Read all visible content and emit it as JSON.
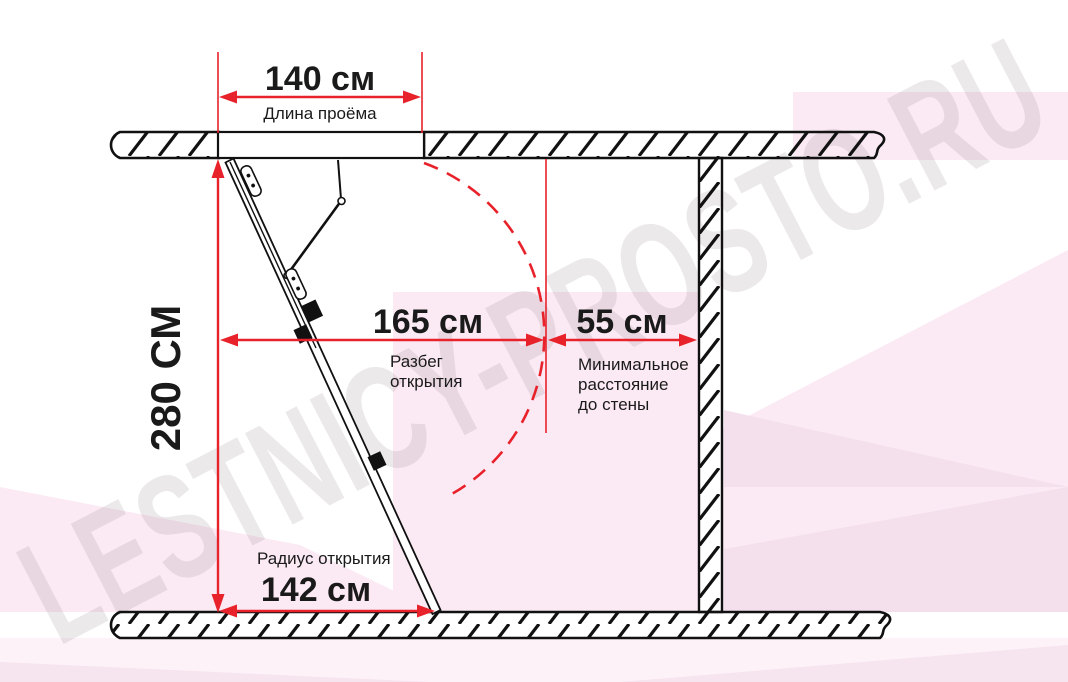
{
  "watermark": "LESTNICY-PROSTO.RU",
  "colors": {
    "dimension_red": "#e8222b",
    "line_black": "#111111",
    "text_black": "#1a1a1a",
    "pink_light": "#fbeaf4",
    "pink_lighter": "#fdf2f8",
    "pink_dark": "#f4e0ec"
  },
  "dimensions": {
    "opening_length": {
      "value": "140 см",
      "label": "Длина проёма"
    },
    "room_height": {
      "value": "280 СМ"
    },
    "opening_span": {
      "value": "165 см",
      "label_lines": [
        "Разбег",
        "открытия"
      ]
    },
    "wall_distance": {
      "value": "55 см",
      "label_lines": [
        "Минимальное",
        "расстояние",
        "до стены"
      ]
    },
    "opening_radius": {
      "value": "142 см",
      "label": "Радиус открытия"
    }
  }
}
